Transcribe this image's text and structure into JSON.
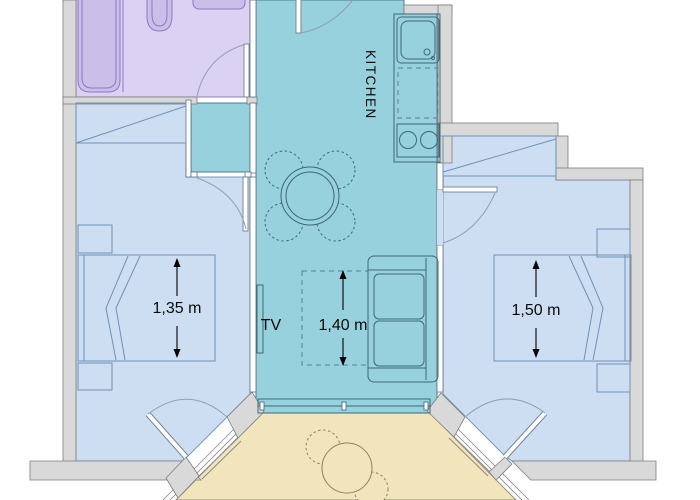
{
  "labels": {
    "kitchen": "KITCHEN",
    "tv": "TV"
  },
  "dimensions": {
    "left_bed": "1,35 m",
    "living": "1,40 m",
    "right_bed": "1,50 m"
  },
  "colors": {
    "hall_teal": "#96d1dd",
    "bedroom_blue": "#cddef2",
    "bathroom_purple": "#dbd1f2",
    "bathroom_fixture": "#cabfe9",
    "balcony_yellow": "#f2e5bc",
    "wall_gray": "#d9d9d9"
  }
}
